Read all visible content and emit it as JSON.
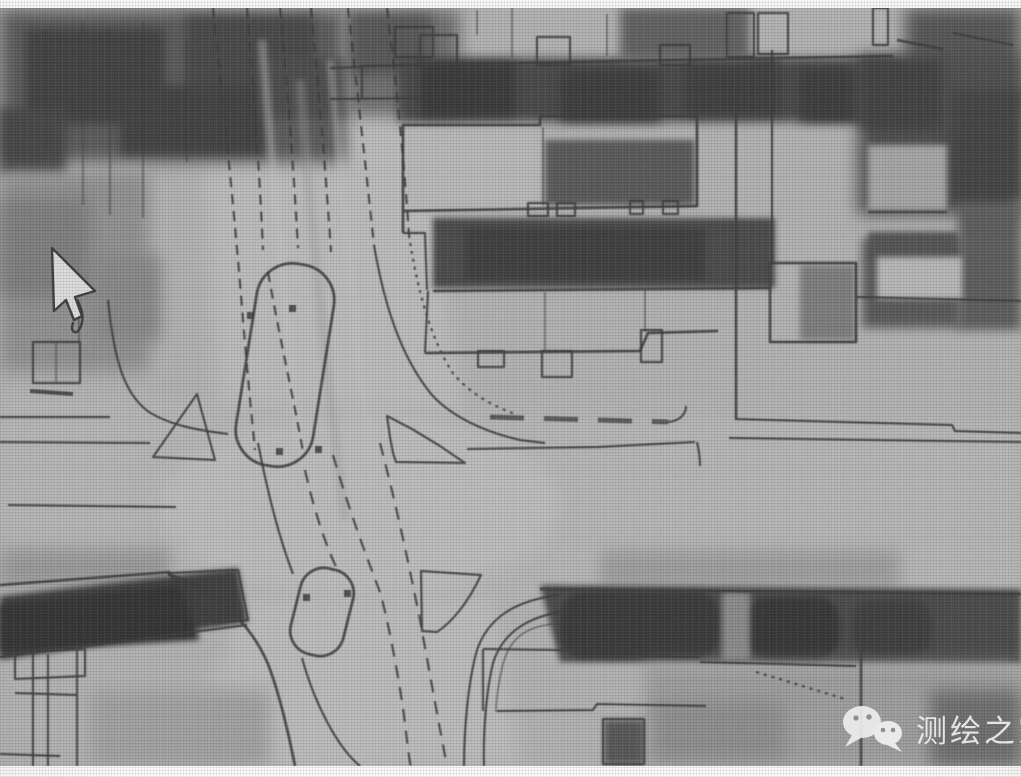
{
  "watermark": {
    "label": "测绘之家",
    "icon": "wechat-icon"
  },
  "cursor": {
    "shape": "arrow"
  },
  "scene": {
    "kind": "aerial-orthophoto-with-digitized-vector-linework",
    "intersection": "cross-roads-with-median-islands"
  },
  "colors": {
    "photo_base": "#b3b3b3",
    "linework": "#3b3b3b",
    "vegetation_dark": "#454545",
    "hedge_dark": "#3a3a3a",
    "watermark_text": "#eeeeee",
    "border_band": "#f8f8f8"
  }
}
